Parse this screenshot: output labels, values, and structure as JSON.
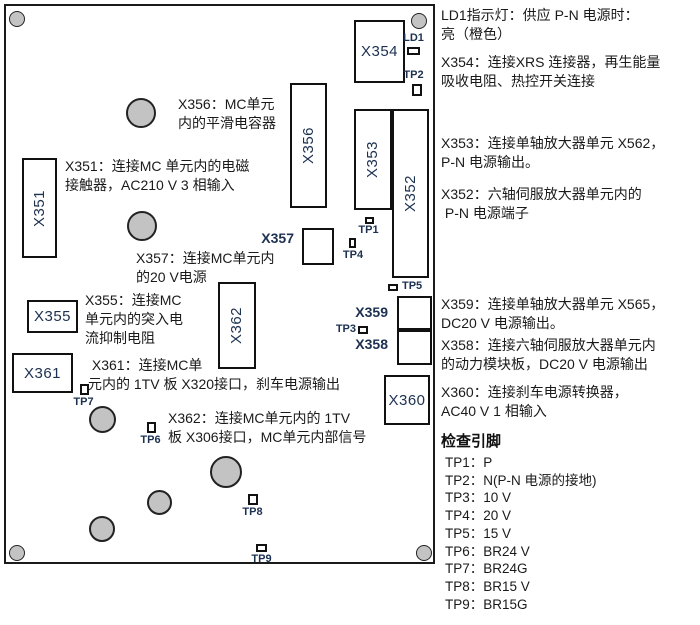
{
  "labels": {
    "x351": "X351",
    "x352": "X352",
    "x353": "X353",
    "x354": "X354",
    "x355": "X355",
    "x356": "X356",
    "x357": "X357",
    "x358": "X358",
    "x359": "X359",
    "x360": "X360",
    "x361": "X361",
    "x362": "X362",
    "ld1": "LD1",
    "tp1": "TP1",
    "tp2": "TP2",
    "tp3": "TP3",
    "tp4": "TP4",
    "tp5": "TP5",
    "tp6": "TP6",
    "tp7": "TP7",
    "tp8": "TP8",
    "tp9": "TP9"
  },
  "board_notes": {
    "x356": "X356：MC单元\n内的平滑电容器",
    "x351": "X351：连接MC 单元内的电磁\n接触器，AC210 V 3 相输入",
    "x357": "X357：连接MC单元内\n的20 V电源",
    "x355": "X355：连接MC\n单元内的突入电\n流抑制电阻",
    "x361": " X361：连接MC单\n元内的 1TV 板 X320接口，刹车电源输出",
    "x362": "X362：连接MC单元内的 1TV\n板 X306接口，MC单元内部信号"
  },
  "side_notes": {
    "ld1": "LD1指示灯：供应 P-N 电源时：\n亮（橙色）",
    "x354": "X354：连接XRS 连接器，再生能量\n吸收电阻、热控开关连接",
    "x353": "X353：连接单轴放大器单元 X562，\nP-N 电源输出。",
    "x352": "X352：六轴伺服放大器单元内的\n P-N 电源端子",
    "x359": "X359：连接单轴放大器单元 X565，\nDC20 V 电源输出。",
    "x358": "X358：连接六轴伺服放大器单元内\n的动力模块板，DC20 V 电源输出",
    "x360": "X360：连接刹车电源转换器，\nAC40 V 1 相输入"
  },
  "check_pins": {
    "heading": "检查引脚",
    "items": [
      "TP1：P",
      "TP2：N(P-N 电源的接地)",
      "TP3：10 V",
      "TP4：20 V",
      "TP5：15 V",
      "TP6：BR24 V",
      "TP7：BR24G",
      "TP8：BR15 V",
      "TP9：BR15G"
    ]
  },
  "colors": {
    "pad_fill": "#c3c3c3",
    "outline": "#111111",
    "connector_label": "#1c3050",
    "text": "#1a1a1a",
    "led_on_color_named_in_text": "橙色"
  }
}
